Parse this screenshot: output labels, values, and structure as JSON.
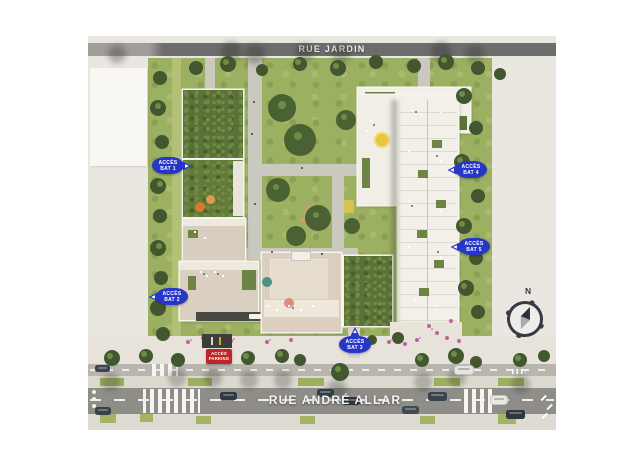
{
  "streets": {
    "top": "RUE JARDIN",
    "bottom": "RUE ANDRÉ ALLAR"
  },
  "access_badges": [
    {
      "id": "bat-1",
      "line1": "ACCÈS",
      "line2": "BAT 1",
      "pointer": "right"
    },
    {
      "id": "bat-2",
      "line1": "ACCÈS",
      "line2": "BAT 2",
      "pointer": "left"
    },
    {
      "id": "bat-3",
      "line1": "ACCÈS",
      "line2": "BAT 3",
      "pointer": "up"
    },
    {
      "id": "bat-4",
      "line1": "ACCÈS",
      "line2": "BAT 4",
      "pointer": "left"
    },
    {
      "id": "bat-5",
      "line1": "ACCÈS",
      "line2": "BAT 5",
      "pointer": "left"
    }
  ],
  "parking_badge": {
    "line1": "ACCÈS",
    "line2": "PARKING"
  },
  "compass": {
    "label": "N"
  },
  "colors": {
    "badge_blue": "#2636c8",
    "badge_red": "#bf2429",
    "road_top": "#6d6d6b",
    "road_main": "#8e8d88",
    "green_base": "#9cb061",
    "roof_green": "#5b7137",
    "roof_beige": "#d9cfc0",
    "roof_white": "#f2efe9"
  }
}
